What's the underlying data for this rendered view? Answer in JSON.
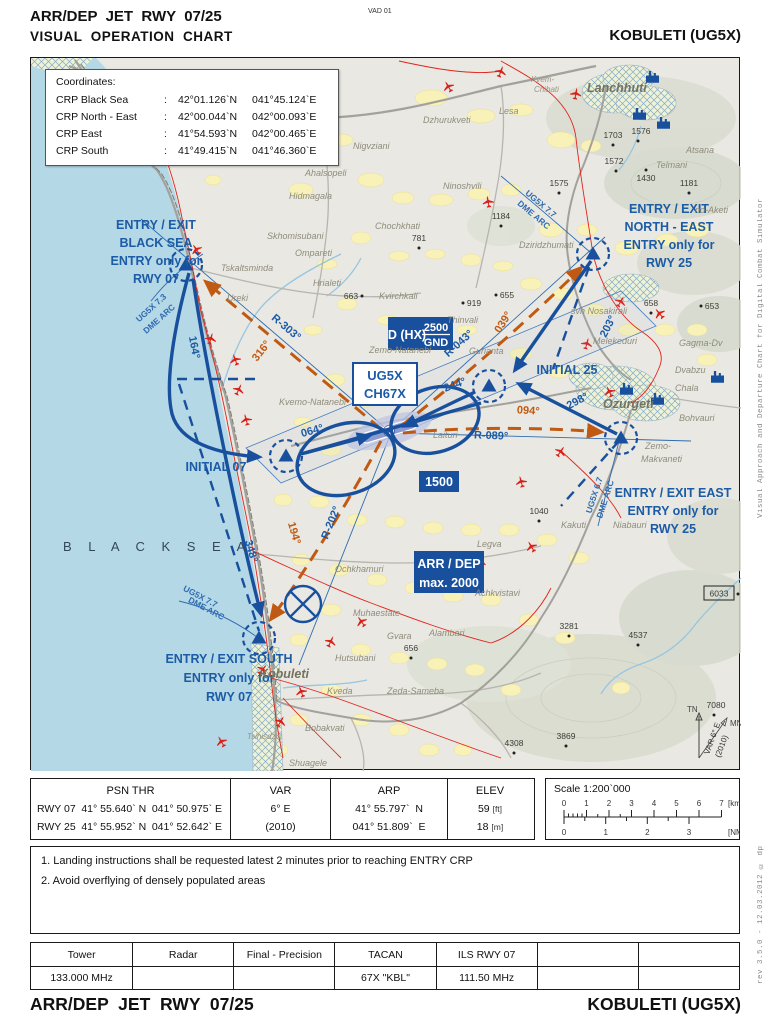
{
  "header": {
    "title_line1": "ARR/DEP  JET  RWY  07/25",
    "title_line2": "VISUAL  OPERATION  CHART",
    "doc_code": "VAD 01",
    "airport": "KOBULETI (UG5X)"
  },
  "footer": {
    "title": "ARR/DEP  JET  RWY  07/25",
    "airport": "KOBULETI (UG5X)"
  },
  "side_text": {
    "top": "Visual Approach and Departure Chart for Digital Combat Simulator",
    "bottom": "rev 3.5.0  -  12.03.2012 © dp"
  },
  "coordinates_box": {
    "title": "Coordinates:",
    "rows": [
      {
        "name": "CRP Black Sea",
        "colon": ":",
        "lat": "42°01.126`N",
        "lon": "041°45.124`E"
      },
      {
        "name": "CRP North - East",
        "colon": ":",
        "lat": "42°00.044`N",
        "lon": "042°00.093`E"
      },
      {
        "name": "CRP East",
        "colon": ":",
        "lat": "41°54.593`N",
        "lon": "042°00.465`E"
      },
      {
        "name": "CRP South",
        "colon": ":",
        "lat": "41°49.415`N",
        "lon": "041°46.360`E"
      }
    ]
  },
  "map": {
    "sea_label": "B L A C K    S E A",
    "entry_labels": {
      "black_sea": {
        "l1": "ENTRY / EXIT",
        "l2": "BLACK SEA",
        "l3": "ENTRY only for",
        "l4": "RWY 07"
      },
      "north_east": {
        "l1": "ENTRY / EXIT",
        "l2": "NORTH - EAST",
        "l3": "ENTRY only for",
        "l4": "RWY 25"
      },
      "east": {
        "l1": "ENTRY / EXIT EAST",
        "l2": "ENTRY only for",
        "l3": "RWY 25"
      },
      "south": {
        "l1": "ENTRY / EXIT SOUTH",
        "l2": "ENTRY only for",
        "l3": "RWY 07"
      }
    },
    "initials": {
      "i07": "INITIAL 07",
      "i25": "INITIAL 25"
    },
    "courses": {
      "c164": "164°",
      "c348": "348°",
      "c064": "064°",
      "c244": "244°",
      "c203": "203°",
      "c298": "298°",
      "d316": "316°",
      "d039": "039°",
      "d094": "094°",
      "d194": "194°",
      "r303": "R-303°",
      "r043": "R-043°",
      "r089": "R-089°",
      "r202": "R-202°"
    },
    "arcs": {
      "bs1": "UG5X 7.3",
      "bs2": "DME ARC",
      "ne1": "UG5X 7.7",
      "ne2": "DME ARC",
      "e1": "UG5X 6.7",
      "e2": "DME ARC",
      "s1": "UG5X 7.7",
      "s2": "DME ARC"
    },
    "boxes": {
      "danger": "D (HX)",
      "danger_top": "2500",
      "danger_bottom": "GND",
      "navaid1": "UG5X",
      "navaid2": "CH67X",
      "alt1500": "1500",
      "arrdep1": "ARR / DEP",
      "arrdep2": "max. 2000"
    },
    "places": {
      "kvem1": "Kvem-",
      "kvem2": "Chibati",
      "lanchhuti": "Lanchhuti",
      "atsana": "Atsana",
      "telmani": "Telmani",
      "dzhurukveti": "Dzhurukveti",
      "lesa": "Lesa",
      "nigvziani": "Nigvziani",
      "ahalsopeli": "Ahalsopeli",
      "hidmagala": "Hidmagala",
      "ninoshvili": "Ninoshvili",
      "chochkhati": "Chochkhati",
      "skhomisubani": "Skhomisubani",
      "ompareti": "Ompareti",
      "tskaltsminda": "Tskaltsminda",
      "ureki": "Ureki",
      "hrialeti": "Hrialeti",
      "kvirchkali": "Kvirchkali",
      "thinvali": "Thinvali",
      "zemo_natanebi": "Zemo-Natanebi",
      "gurianta": "Gurianta",
      "kvemo_natanebi": "Kvemo-Natanebi",
      "laituri": "Laituri",
      "dziridzhumati": "Dziridzhumati",
      "no_aketi": "no-Aketi",
      "svh_nosakirali": "svh Nosakirali",
      "melekeduri": "Melekeduri",
      "gagma": "Gagma-Dv",
      "dvabzu": "Dvabzu",
      "chala": "Chala",
      "ozurgeti": "Ozurgeti",
      "bohvauri": "Bohvauri",
      "zemo_mak1": "Zemo-",
      "zemo_mak2": "Makvaneti",
      "kakuti": "Kakuti",
      "niabauri": "Niabauri",
      "legva": "Legva",
      "achkvistavi": "Achkvistavi",
      "ochkhamuri": "Ochkhamuri",
      "muhaestate": "Muhaestate",
      "gvara": "Gvara",
      "alambari": "Alambari",
      "hutsubani": "Hutsubani",
      "kveda": "Kveda",
      "zeda_sameba": "Zeda-Sameba",
      "bobakvati": "Bobakvati",
      "shuagele": "Shuagele",
      "kobuleti": "Kobuleti",
      "tsihisdziri": "Tsihisdziri"
    },
    "elevations": {
      "e1703": "1703",
      "e1576": "1576",
      "e1572": "1572",
      "e1430": "1430",
      "e1575": "1575",
      "e1181": "1181",
      "e1184": "1184",
      "e781": "781",
      "e663": "663",
      "e919": "919",
      "e655": "655",
      "e658": "658",
      "e653": "653",
      "e1040": "1040",
      "e656": "656",
      "e3281": "3281",
      "e4537": "4537",
      "e6033": "6033",
      "e7080": "7080",
      "e4308": "4308",
      "e3869": "3869"
    },
    "compass": {
      "tn": "TN",
      "mn": "MN",
      "var1": "VAR 6° E",
      "var2": "(2010)"
    }
  },
  "info_table": {
    "psn_thr_header": "PSN THR",
    "rwy07": {
      "label": "RWY 07",
      "lat": "41° 55.640` N",
      "lon": "041° 50.975` E"
    },
    "rwy25": {
      "label": "RWY 25",
      "lat": "41° 55.952` N",
      "lon": "041° 52.642` E"
    },
    "var_header": "VAR",
    "var_value": "6° E",
    "var_year": "(2010)",
    "arp_header": "ARP",
    "arp_lat": "41° 55.797`  N",
    "arp_lon": "041° 51.809`  E",
    "elev_header": "ELEV",
    "elev_ft": "59",
    "elev_ft_unit": "[ft]",
    "elev_m": "18",
    "elev_m_unit": "[m]"
  },
  "scale_box": {
    "title": "Scale 1:200`000",
    "km_labels": [
      "0",
      "1",
      "2",
      "3",
      "4",
      "5",
      "6",
      "7"
    ],
    "km_unit": "[km]",
    "nm_labels": [
      "0",
      "1",
      "2",
      "3"
    ],
    "nm_unit": "[NM]"
  },
  "notes": {
    "n1": "1. Landing instructions shall be requested latest 2 minutes prior to reaching ENTRY CRP",
    "n2": "2. Avoid overflying of densely populated areas"
  },
  "freq_table": {
    "headers": [
      "Tower",
      "Radar",
      "Final - Precision",
      "TACAN",
      "ILS RWY 07",
      "",
      ""
    ],
    "values": [
      "133.000 MHz",
      "",
      "",
      "67X \"KBL\"",
      "111.50 MHz",
      "",
      ""
    ]
  }
}
